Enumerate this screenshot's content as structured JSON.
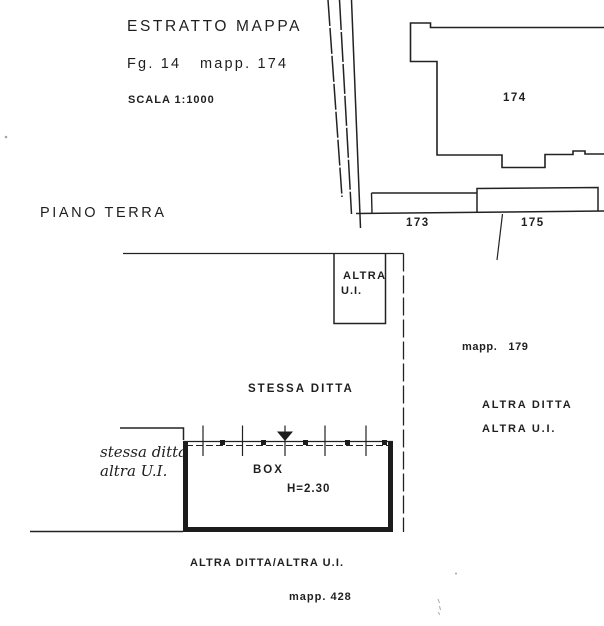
{
  "header": {
    "title": "ESTRATTO MAPPA",
    "sheet_ref": "Fg. 14   mapp. 174",
    "scale": "SCALA 1:1000"
  },
  "map": {
    "parcels": {
      "p174": "174",
      "p173": "173",
      "p175": "175"
    },
    "mapp_179": "mapp.   179"
  },
  "floor_plan": {
    "section_label": "PIANO TERRA",
    "neighbor_unit": {
      "line1": "ALTRA",
      "line2": "U.I."
    },
    "same_owner_label": "STESSA DITTA",
    "handwritten_note": {
      "line1": "stessa ditta",
      "line2": "altra U.I."
    },
    "unit_label": "BOX",
    "height_label": "H=2.30"
  },
  "annotations": {
    "altra_ditta": "ALTRA DITTA",
    "altra_ui": "ALTRA U.I.",
    "bottom_owner_label": "ALTRA DITTA/ALTRA U.I.",
    "mapp_428": "mapp. 428"
  },
  "colors": {
    "ink": "#1f1f1f",
    "paper": "#ffffff"
  }
}
